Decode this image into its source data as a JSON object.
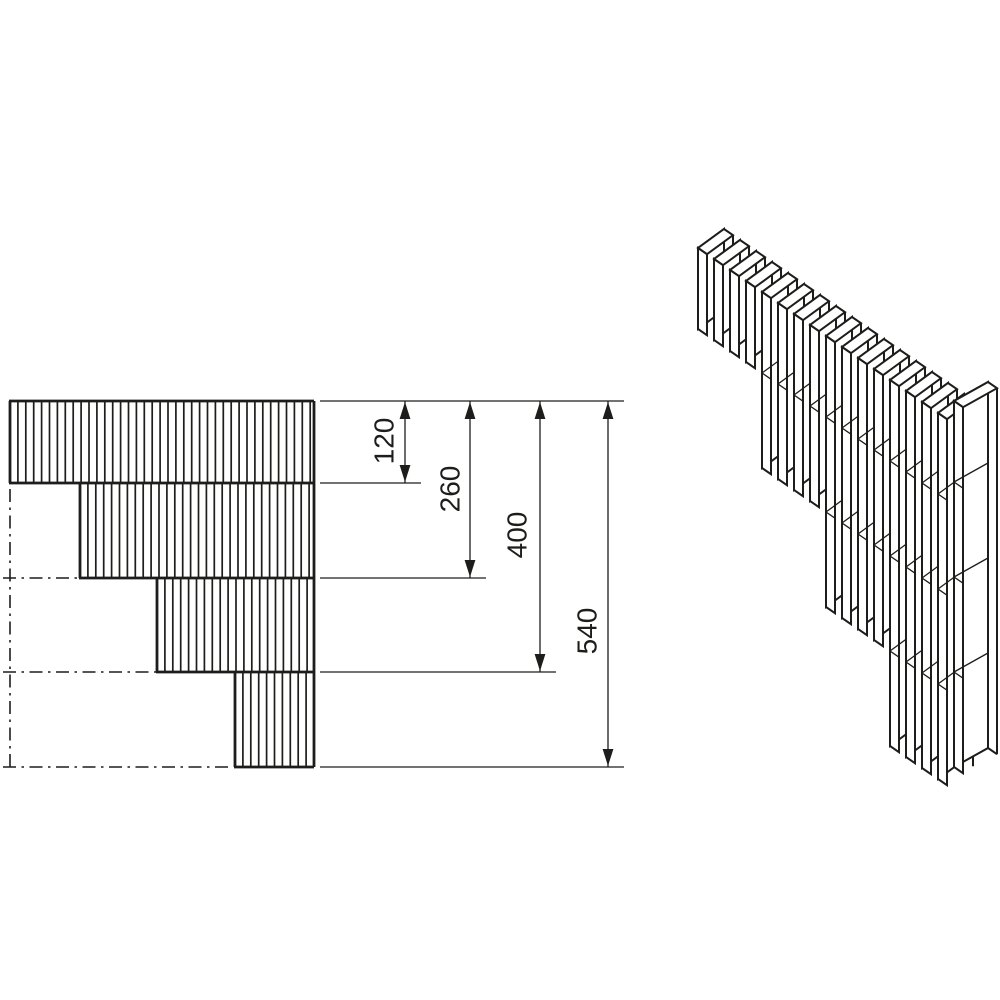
{
  "page": {
    "background": "#ffffff",
    "ink": "#1d1d1b",
    "description": "Technical drawing of a stepped masonry wall corner: left stepped elevation with hatching and stacked dimensions, right isometric view of lamella blocks"
  },
  "views": {
    "elevation": {
      "name": "stepped-corner-elevation",
      "right_edge": 314,
      "hatch_pitch": 7.9,
      "rows": [
        {
          "top": 401,
          "bottom": 483,
          "left": 10
        },
        {
          "top": 483,
          "bottom": 578,
          "left": 80
        },
        {
          "top": 578,
          "bottom": 672,
          "left": 157
        },
        {
          "top": 672,
          "bottom": 767,
          "left": 235
        }
      ],
      "centerlines": {
        "vertical": {
          "x": 10,
          "y1": 489,
          "y2": 767
        },
        "horizontal": [
          {
            "y": 578,
            "x1": 3,
            "x2": 156
          },
          {
            "y": 672,
            "x1": 3,
            "x2": 234
          },
          {
            "y": 767,
            "x1": 3,
            "x2": 233
          }
        ]
      }
    },
    "dimensions": {
      "baseline_y": 401,
      "ext_from_x": 320,
      "ext_overshoot": 16,
      "items": [
        {
          "label": "120",
          "value": 120,
          "line_x": 405,
          "to_y": 483,
          "text_x": 386,
          "text_y": 441
        },
        {
          "label": "260",
          "value": 260,
          "line_x": 470,
          "to_y": 578,
          "text_x": 452,
          "text_y": 489
        },
        {
          "label": "400",
          "value": 400,
          "line_x": 540,
          "to_y": 672,
          "text_x": 519,
          "text_y": 535
        },
        {
          "label": "540",
          "value": 540,
          "line_x": 608,
          "to_y": 767,
          "text_x": 589,
          "text_y": 631
        }
      ]
    },
    "isometric": {
      "name": "corner-isometric",
      "start": [
        698,
        248
      ],
      "u": [
        16,
        11
      ],
      "t": [
        9,
        6.2
      ],
      "v": [
        26,
        -19
      ],
      "course_heights": [
        81,
        95,
        95,
        95
      ],
      "tiers": [
        {
          "slats": 4,
          "courses": 1
        },
        {
          "slats": 4,
          "courses": 2
        },
        {
          "slats": 4,
          "courses": 3
        },
        {
          "slats": 4,
          "courses": 4
        }
      ],
      "column": {
        "pos": [
          954,
          401
        ],
        "t": [
          9,
          6.2
        ],
        "v": [
          34,
          -19
        ],
        "courses": 4
      }
    }
  },
  "style": {
    "stroke_border": 2.8,
    "stroke_hatch": 1.7,
    "stroke_thin": 1.3,
    "stroke_iso": 2.0,
    "stroke_joint": 1.3,
    "font_size": 28,
    "dash_pattern": "13 5.5 2.5 5.5",
    "arrow_len": 17,
    "arrow_halfwidth": 5.4
  }
}
